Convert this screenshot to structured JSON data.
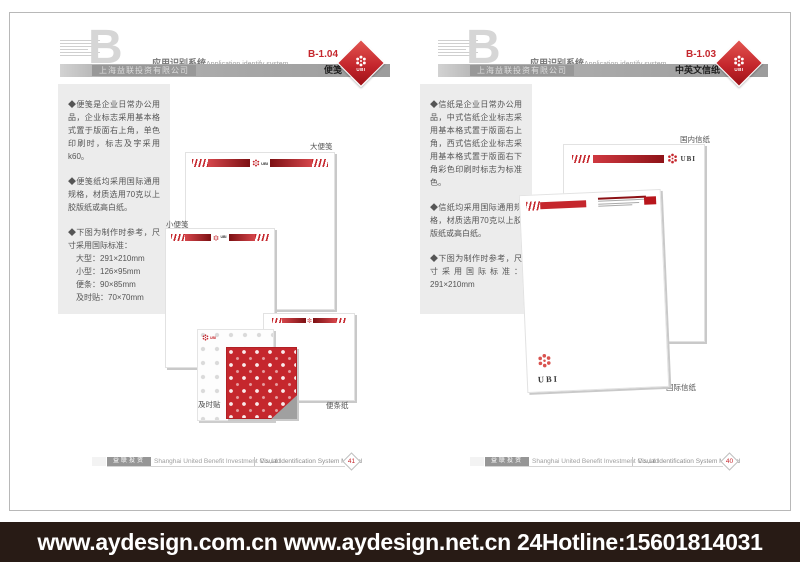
{
  "shared": {
    "section_letter": "B",
    "section_title_cn": "应用识别系统",
    "section_title_en": "Application identify system",
    "company_cn": "上海益联投资有限公司",
    "logo_text": "UBI",
    "footer_block_cn": "益联投资",
    "footer_company_en": "Shanghai United Benefit Investment Co.,Ltd",
    "footer_manual_en": "Visual Identification System Manual"
  },
  "pages": [
    {
      "code": "B-1.04",
      "page_title": "便笺",
      "page_no": "41",
      "panel": {
        "p1": "◆便笺是企业日常办公用品，企业标志采用基本格式置于版面右上角，单色印刷时，标志及字采用k60。",
        "p2": "◆便笺纸均采用国际通用规格，材质选用70克以上胶版纸或高白纸。",
        "p3": "◆下图为制作时参考，尺寸采用国际标准：",
        "sizes": [
          "大型：291×210mm",
          "小型：126×95mm",
          "便条：90×85mm",
          "及时贴：70×70mm"
        ]
      },
      "labels": {
        "large": "大便笺",
        "small": "小便笺",
        "sticky": "及时贴",
        "note": "便条纸"
      }
    },
    {
      "code": "B-1.03",
      "page_title": "中英文信纸",
      "page_no": "40",
      "panel": {
        "p1": "◆信纸是企业日常办公用品，中式信纸企业标志采用基本格式置于版面右上角，西式信纸企业标志采用基本格式置于版面右下角彩色印刷时标志为标准色。",
        "p2": "◆信纸均采用国际通用规格，材质选用70克以上胶版纸或高白纸。",
        "p3": "◆下图为制作时参考，尺寸采用国际标准：291×210mm"
      },
      "labels": {
        "domestic": "国内信纸",
        "international": "国际信纸"
      }
    }
  ],
  "banner": {
    "text": "www.aydesign.com.cn www.aydesign.net.cn 24Hotline:15601814031"
  },
  "colors": {
    "accent": "#c5272d",
    "accent_dark": "#8e1318",
    "bar_gray": "#a8a8a8",
    "panel_gray": "#ececec",
    "banner_bg": "#281b15"
  }
}
